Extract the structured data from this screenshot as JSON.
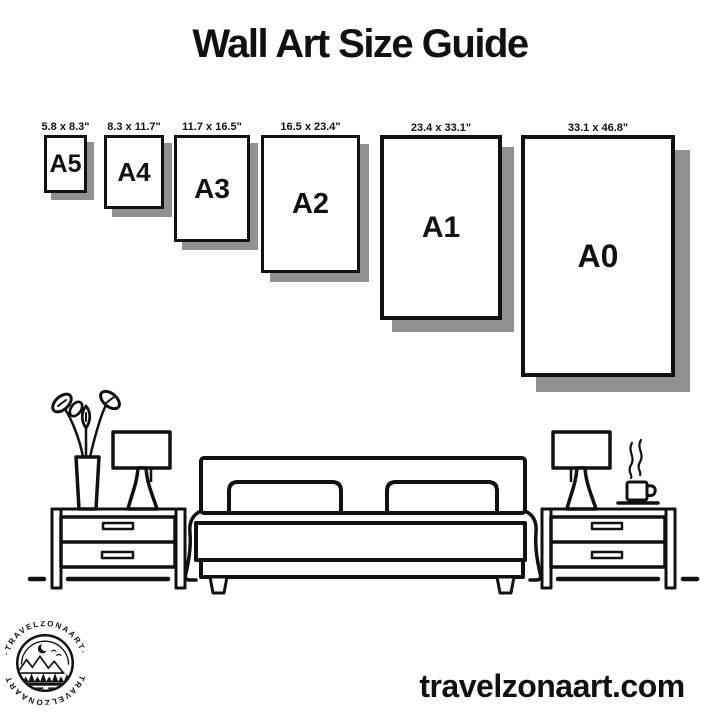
{
  "title": "Wall Art Size Guide",
  "sizes": [
    {
      "name": "A5",
      "dimensions": "5.8 x 8.3\""
    },
    {
      "name": "A4",
      "dimensions": "8.3 x 11.7\""
    },
    {
      "name": "A3",
      "dimensions": "11.7 x 16.5\""
    },
    {
      "name": "A2",
      "dimensions": "16.5 x 23.4\""
    },
    {
      "name": "A1",
      "dimensions": "23.4 x 33.1\""
    },
    {
      "name": "A0",
      "dimensions": "33.1 x 46.8\""
    }
  ],
  "illustration": {
    "icons": [
      "vase-with-flowers-icon",
      "table-lamp-icon",
      "nightstand-icon",
      "double-bed-icon",
      "coffee-cup-icon",
      "steam-icon",
      "floor-dash-icon"
    ]
  },
  "logo": {
    "text_top": "·TRAVELZONAART·",
    "text_bottom": "TRAVELZONAART"
  },
  "website": "travelzonaart.com",
  "colors": {
    "ink": "#111111",
    "shadow": "#919191",
    "background": "#ffffff"
  }
}
